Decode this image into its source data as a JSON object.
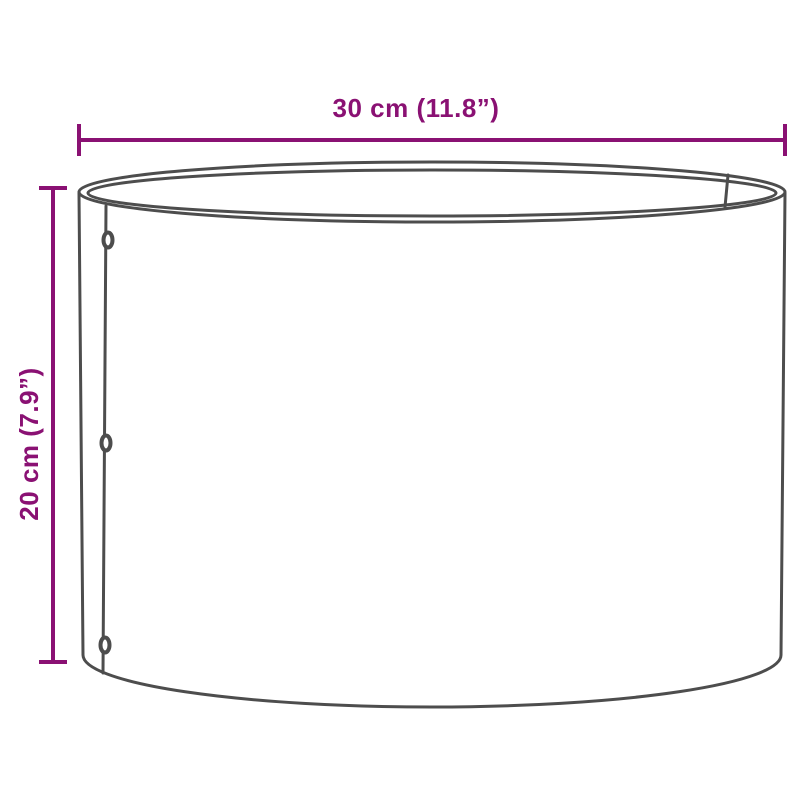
{
  "colors": {
    "dimension": "#8A1173",
    "outline": "#4D4D4D",
    "background": "#FFFFFF"
  },
  "diagram": {
    "subject": "cylindrical-ring-line-drawing",
    "rivet_count": 3
  },
  "dimensions": {
    "width": {
      "label": "30 cm (11.8”)"
    },
    "height": {
      "label": "20 cm (7.9”)"
    }
  }
}
